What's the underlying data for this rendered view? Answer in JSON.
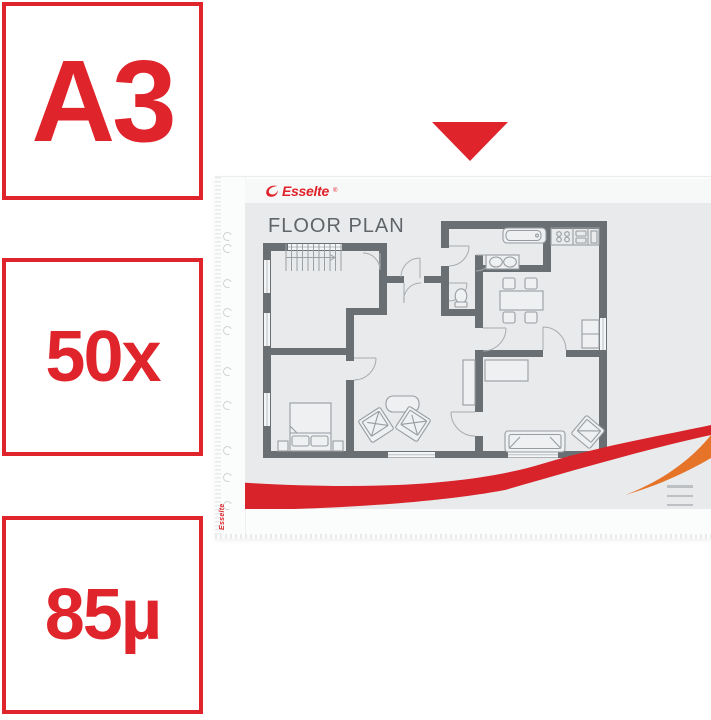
{
  "badges": [
    {
      "id": "format",
      "label": "A3"
    },
    {
      "id": "quantity",
      "label": "50x"
    },
    {
      "id": "thickness",
      "label": "85µ"
    }
  ],
  "arrow": {
    "shape": "triangle-down",
    "color": "#e0242b"
  },
  "product": {
    "brand_logo": "Esselte",
    "brand_mark": "®",
    "document_title": "FLOOR PLAN",
    "side_brand": "Esselte",
    "fine_print": {
      "lines": 3
    }
  },
  "colors": {
    "accent_red": "#e0242b",
    "swoosh_red": "#d8232a",
    "swoosh_orange": "#e57328",
    "paper_gray": "#e9eaeb",
    "wall_gray": "#6a6f73"
  }
}
